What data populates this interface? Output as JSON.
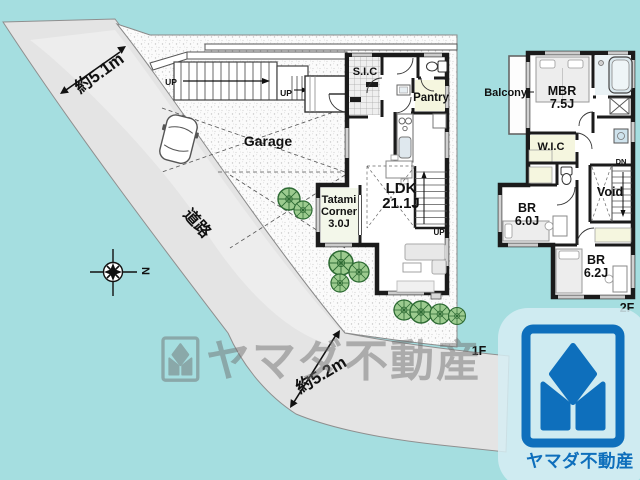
{
  "colors": {
    "background_teal": "#a5dee0",
    "road_gray": "#e4e4e4",
    "wall_black": "#1b1b1b",
    "tree_green": "#9ccb8f",
    "tree_outline": "#2e6b34",
    "closet_cream": "#f5f6df",
    "tatami_green": "#f3f7ea",
    "bath_blue": "#eaf2f5",
    "logo_blue": "#0e6fbc",
    "watermark_gray": "#808080"
  },
  "site": {
    "road_label": "道路",
    "width_top": "約5.1m",
    "width_bottom": "約5.2m",
    "garage": "Garage",
    "floor_tag": "1F",
    "compass_north": "N",
    "stairs_up": "UP"
  },
  "floor1": {
    "entry_closet": "S.I.C",
    "pantry": "Pantry",
    "living": {
      "name": "LDK",
      "size": "21.1J"
    },
    "tatami": {
      "line1": "Tatami",
      "line2": "Corner",
      "size": "3.0J"
    },
    "stairs_up": "UP"
  },
  "floor2": {
    "floor_tag": "2F",
    "balcony": "Balcony",
    "master": {
      "name": "MBR",
      "size": "7.5J"
    },
    "closet": "W.I.C",
    "bedroom1": {
      "name": "BR",
      "size": "6.0J"
    },
    "bedroom2": {
      "name": "BR",
      "size": "6.2J"
    },
    "void_label": "Void",
    "stairs_down": "DN"
  },
  "watermark": {
    "brand": "ヤマダ不動産"
  },
  "logo": {
    "brand": "ヤマダ不動産"
  }
}
